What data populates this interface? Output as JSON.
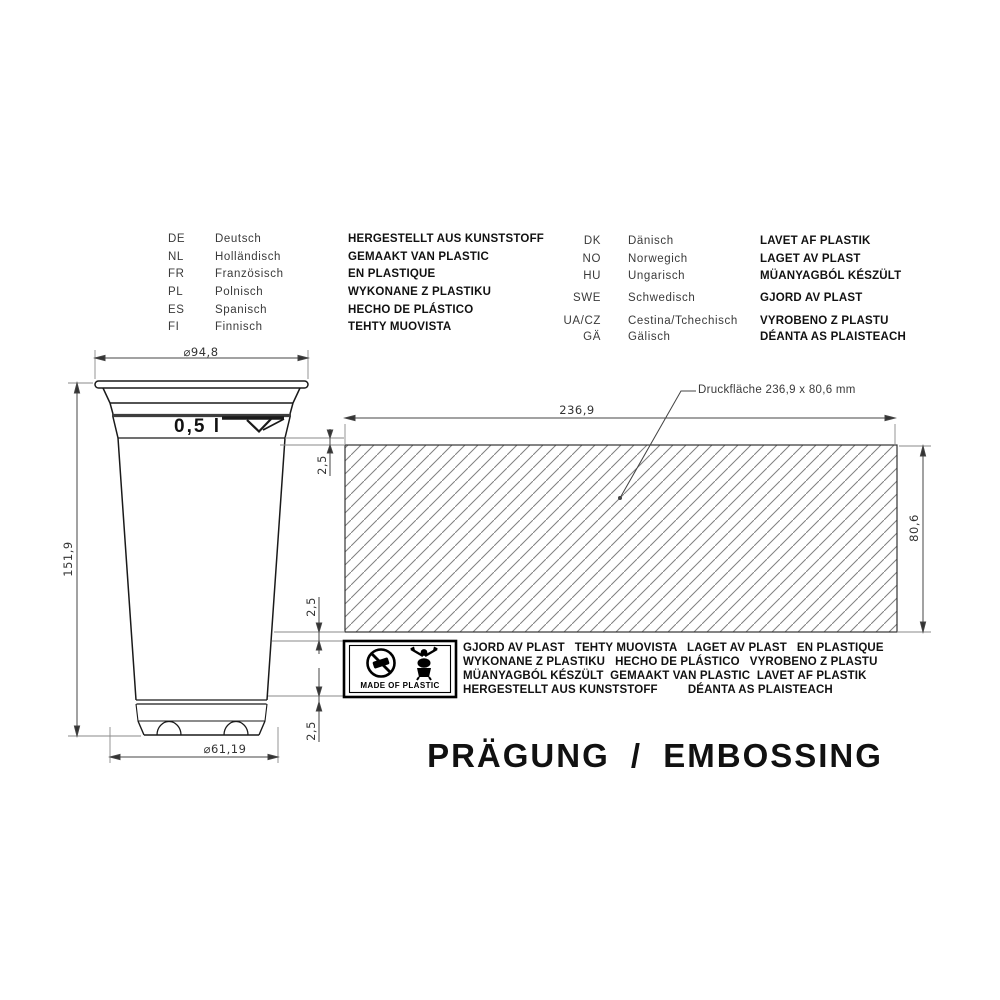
{
  "title": "PRÄGUNG / EMBOSSING",
  "language_table": {
    "left": [
      {
        "code": "DE",
        "language": "Deutsch",
        "text": "HERGESTELLT AUS KUNSTSTOFF"
      },
      {
        "code": "NL",
        "language": "Holländisch",
        "text": "GEMAAKT VAN PLASTIC"
      },
      {
        "code": "FR",
        "language": "Französisch",
        "text": "EN PLASTIQUE"
      },
      {
        "code": "PL",
        "language": "Polnisch",
        "text": "WYKONANE Z PLASTIKU"
      },
      {
        "code": "ES",
        "language": "Spanisch",
        "text": "HECHO DE PLÁSTICO"
      },
      {
        "code": "FI",
        "language": "Finnisch",
        "text": "TEHTY MUOVISTA"
      }
    ],
    "right": [
      {
        "code": "DK",
        "language": "Dänisch",
        "text": "LAVET AF PLASTIK"
      },
      {
        "code": "NO",
        "language": "Norwegich",
        "text": "LAGET AV PLAST"
      },
      {
        "code": "HU",
        "language": "Ungarisch",
        "text": "MÜANYAGBÓL KÉSZÜLT"
      },
      {
        "code": "SWE",
        "language": "Schwedisch",
        "text": "GJORD AV PLAST"
      },
      {
        "code": "UA/CZ",
        "language": "Cestina/Tchechisch",
        "text": "VYROBENO Z PLASTU"
      },
      {
        "code": "GÄ",
        "language": "Gälisch",
        "text": "DÉANTA AS PLAISTEACH"
      }
    ]
  },
  "drawing": {
    "top_diameter": "⌀94,8",
    "height": "151,9",
    "bottom_diameter": "⌀61,19",
    "volume": "0,5 l",
    "print_width": "236,9",
    "print_height": "80,6",
    "margins": [
      "2,5",
      "2,5",
      "2,5"
    ],
    "leader_label": "Druckfläche 236,9 x 80,6 mm"
  },
  "embossing": {
    "badge": "MADE OF PLASTIC",
    "lines": [
      "GJORD AV PLAST   TEHTY MUOVISTA   LAGET AV PLAST   EN PLASTIQUE",
      "WYKONANE Z PLASTIKU   HECHO DE PLÁSTICO   VYROBENO Z PLASTU",
      "MÜANYAGBÓL KÉSZÜLT  GEMAAKT VAN PLASTIC  LAVET AF PLASTIK",
      "HERGESTELLT AUS KUNSTSTOFF         DÉANTA AS PLAISTEACH"
    ]
  }
}
